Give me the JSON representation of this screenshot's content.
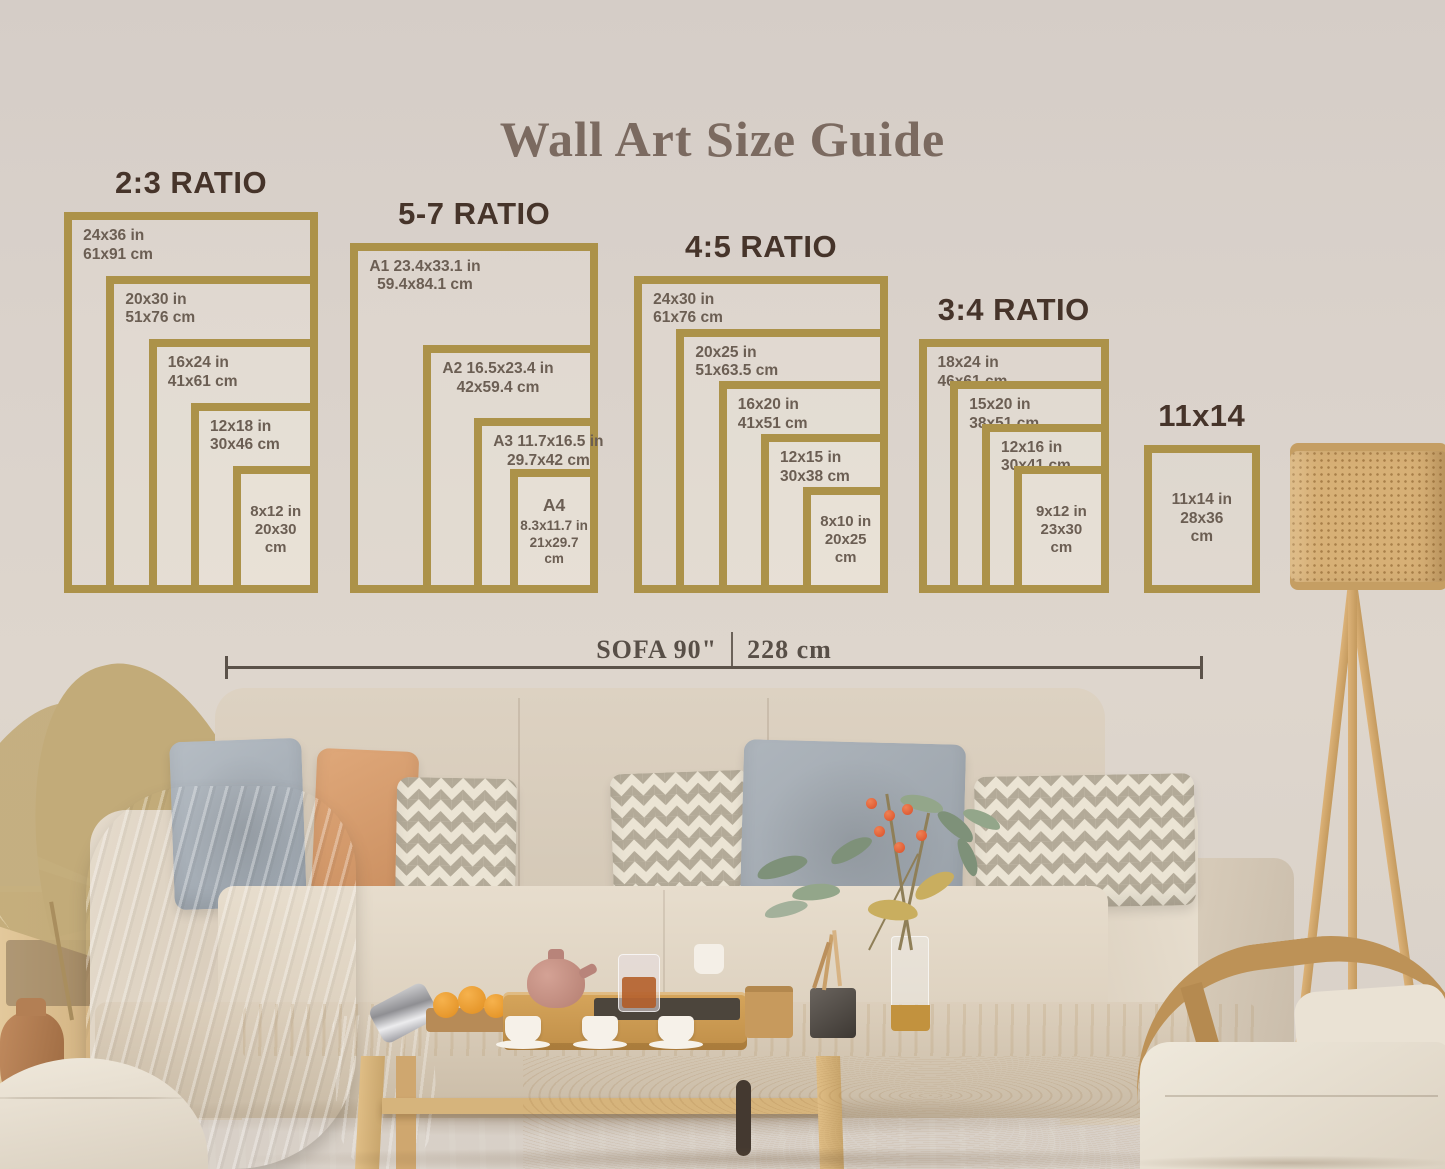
{
  "title": "Wall Art Size Guide",
  "sofa_measure": {
    "imperial": "SOFA 90\"",
    "metric": "228 cm"
  },
  "size_groups": [
    {
      "id": "2-3",
      "title": "2:3 RATIO",
      "frames": [
        {
          "w": 24,
          "h": 36,
          "lines": [
            "24x36 in",
            "61x91 cm"
          ]
        },
        {
          "w": 20,
          "h": 30,
          "lines": [
            "20x30 in",
            "51x76 cm"
          ]
        },
        {
          "w": 16,
          "h": 24,
          "lines": [
            "16x24 in",
            "41x61 cm"
          ]
        },
        {
          "w": 12,
          "h": 18,
          "lines": [
            "12x18 in",
            "30x46 cm"
          ]
        },
        {
          "w": 8,
          "h": 12,
          "lines": [
            "8x12 in",
            "20x30",
            "cm"
          ]
        }
      ]
    },
    {
      "id": "5-7",
      "title": "5-7 RATIO",
      "frames": [
        {
          "w": 23.4,
          "h": 33.1,
          "lines": [
            "A1 23.4x33.1 in",
            "59.4x84.1 cm"
          ]
        },
        {
          "w": 16.5,
          "h": 23.4,
          "lines": [
            "A2 16.5x23.4 in",
            "42x59.4 cm"
          ]
        },
        {
          "w": 11.7,
          "h": 16.5,
          "lines": [
            "A3 11.7x16.5 in",
            "29.7x42 cm"
          ]
        },
        {
          "w": 8.3,
          "h": 11.7,
          "name": "A4",
          "lines": [
            "8.3x11.7 in",
            "21x29.7",
            "cm"
          ]
        }
      ]
    },
    {
      "id": "4-5",
      "title": "4:5 RATIO",
      "frames": [
        {
          "w": 24,
          "h": 30,
          "lines": [
            "24x30 in",
            "61x76 cm"
          ]
        },
        {
          "w": 20,
          "h": 25,
          "lines": [
            "20x25 in",
            "51x63.5 cm"
          ]
        },
        {
          "w": 16,
          "h": 20,
          "lines": [
            "16x20 in",
            "41x51 cm"
          ]
        },
        {
          "w": 12,
          "h": 15,
          "lines": [
            "12x15 in",
            "30x38 cm"
          ]
        },
        {
          "w": 8,
          "h": 10,
          "lines": [
            "8x10 in",
            "20x25",
            "cm"
          ]
        }
      ]
    },
    {
      "id": "3-4",
      "title": "3:4 RATIO",
      "frames": [
        {
          "w": 18,
          "h": 24,
          "lines": [
            "18x24 in",
            "46x61 cm"
          ]
        },
        {
          "w": 15,
          "h": 20,
          "lines": [
            "15x20 in",
            "38x51 cm"
          ]
        },
        {
          "w": 12,
          "h": 16,
          "lines": [
            "12x16 in",
            "30x41 cm"
          ]
        },
        {
          "w": 9,
          "h": 12,
          "lines": [
            "9x12 in",
            "23x30",
            "cm"
          ]
        }
      ]
    },
    {
      "id": "11x14",
      "title": "11x14",
      "frames": [
        {
          "w": 11,
          "h": 14,
          "lines": [
            "11x14 in",
            "28x36",
            "cm"
          ]
        }
      ]
    }
  ],
  "colors": {
    "frame_gold": "#ac9249",
    "ratio_title": "#46342a",
    "size_label": "#6b5e53",
    "heading": "#7b6a60",
    "measure_line": "#5b5249",
    "wall": "#d9d2ca",
    "sofa_beige": "#e0d5c6",
    "pillow_gray": "#aab2ba",
    "pillow_terracotta": "#d9a173",
    "wood": "#ddbe8a",
    "berry_orange": "#e0623c"
  }
}
